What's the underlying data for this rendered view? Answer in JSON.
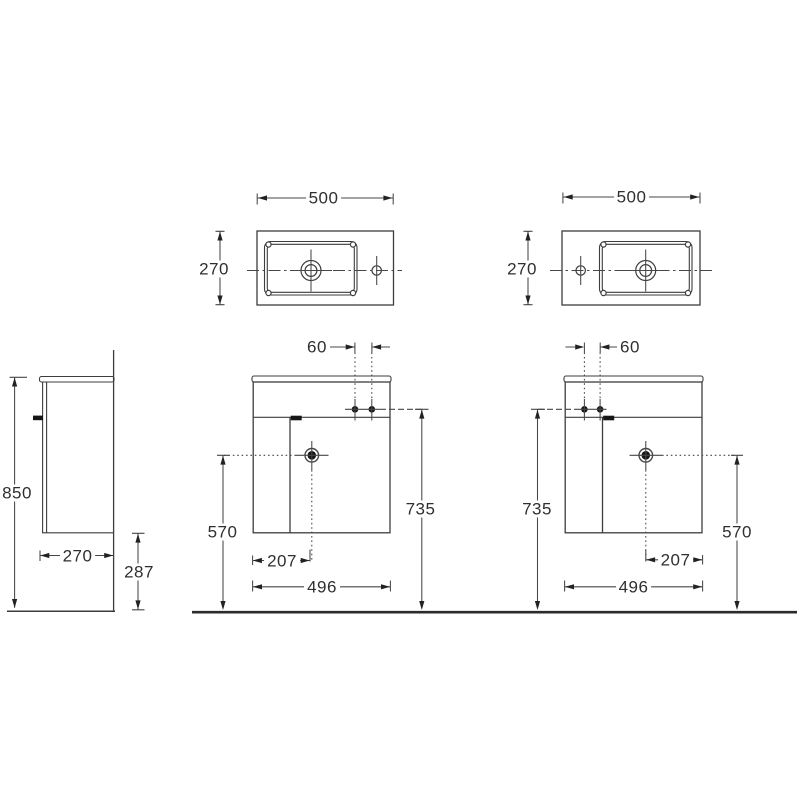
{
  "drawing": {
    "type": "technical-dimension-drawing",
    "subject": "wall-hung cloakroom vanity unit with basin, left-hand and right-hand versions",
    "units": "mm",
    "colors": {
      "background": "#ffffff",
      "line": "#3d3d3d",
      "dim_line": "#474747",
      "text": "#2f2f2f",
      "dot": "#161616",
      "floor": "#2b2b2b"
    },
    "views": {
      "top_left": {
        "name": "basin plan view - bowl left, tap hole right",
        "width": "500",
        "depth": "270"
      },
      "top_right": {
        "name": "basin plan view - bowl right, tap hole left",
        "width": "500",
        "depth": "270"
      },
      "side": {
        "name": "side elevation",
        "height": "850",
        "depth": "270",
        "clearance": "287"
      },
      "front_left": {
        "name": "front elevation - left-hand unit",
        "tap_spacing": "60",
        "height": "735",
        "drain_height": "570",
        "drain_offset": "207",
        "width": "496"
      },
      "front_right": {
        "name": "front elevation - right-hand unit",
        "tap_spacing": "60",
        "height": "735",
        "drain_height": "570",
        "drain_offset": "207",
        "width": "496"
      }
    }
  }
}
